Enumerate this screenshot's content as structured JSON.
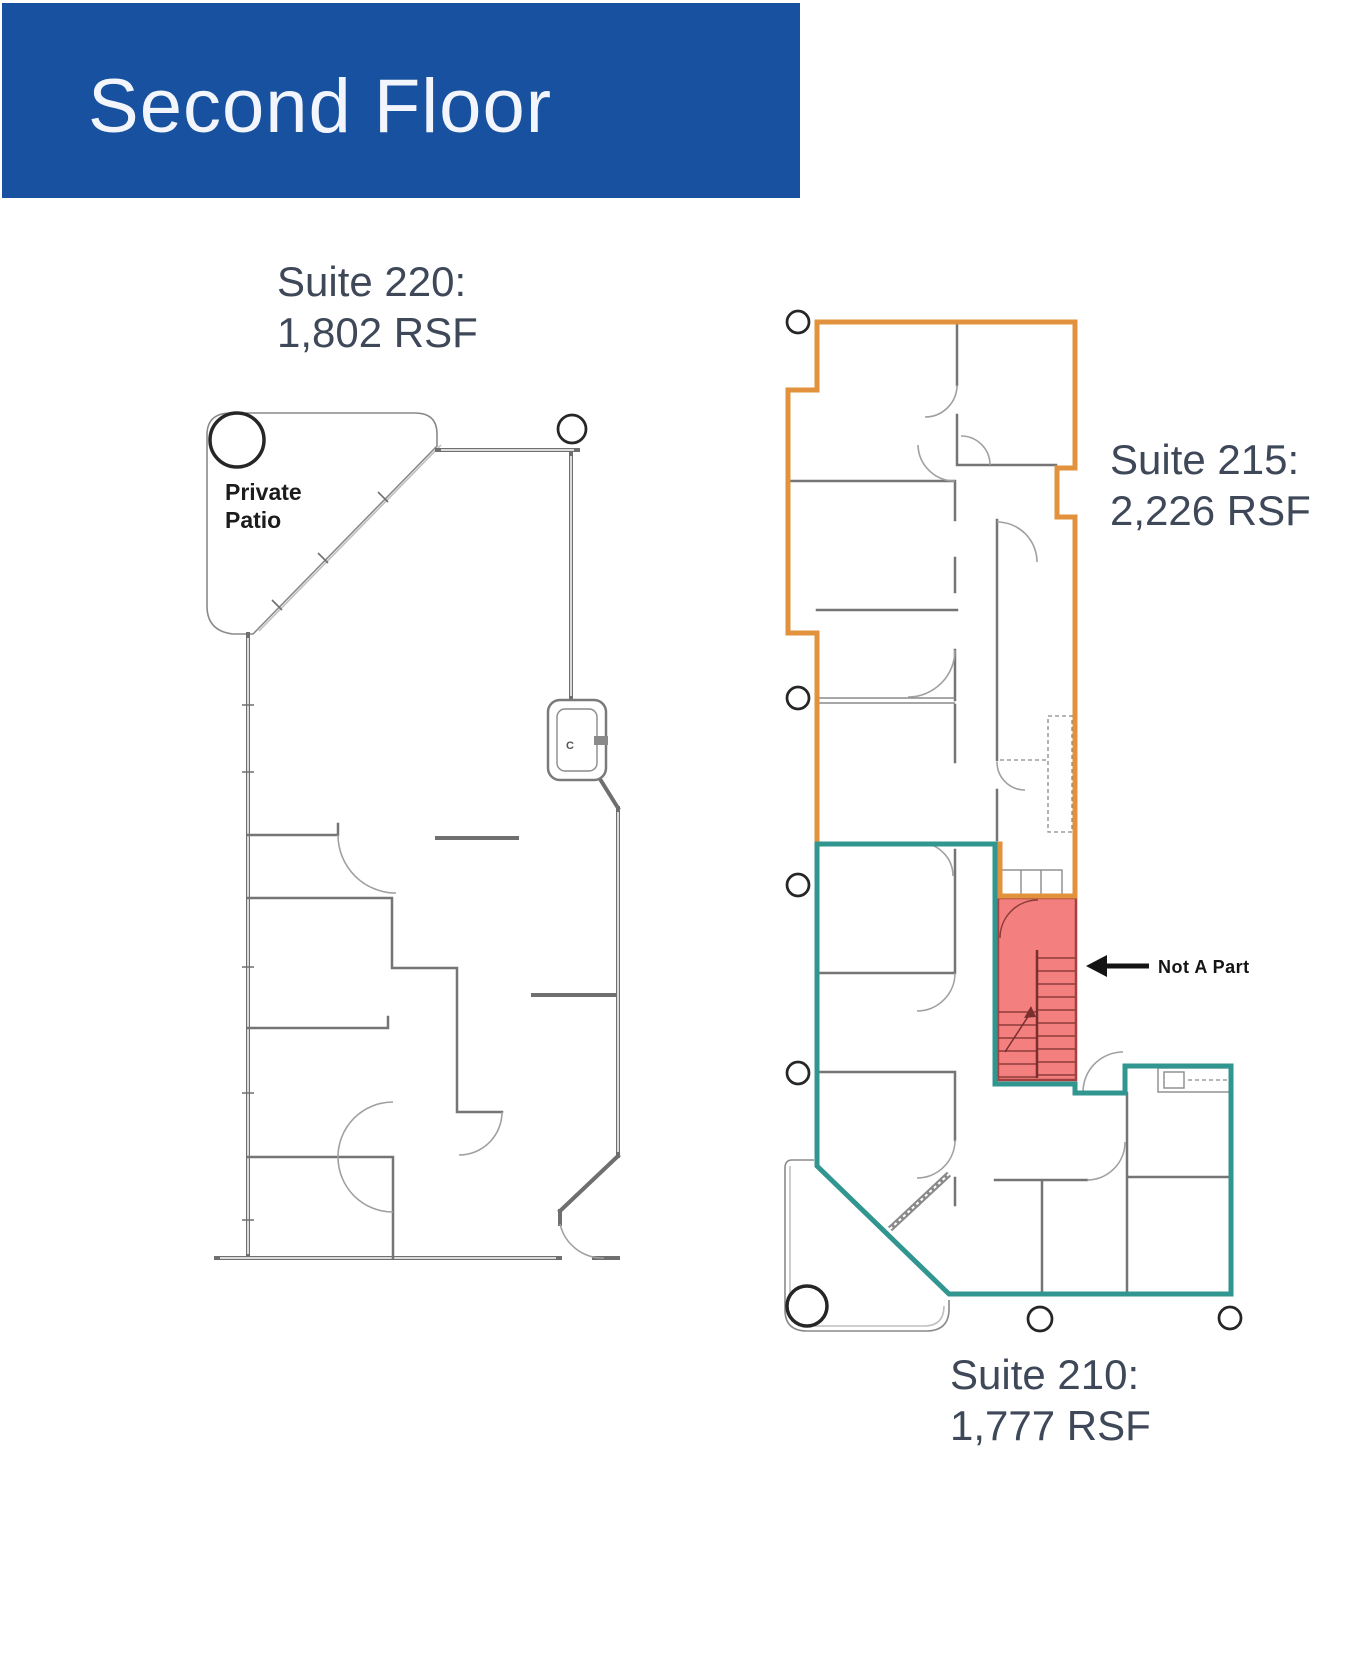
{
  "header": {
    "title": "Second Floor",
    "background_color": "#17519F"
  },
  "plans": {
    "suite_220": {
      "title": "Suite 220:",
      "area": "1,802 RSF",
      "patio_line1": "Private",
      "patio_line2": "Patio",
      "fixture_label": "C"
    },
    "suite_215": {
      "title": "Suite 215:",
      "area": "2,226 RSF",
      "outline_color": "#E2923C"
    },
    "suite_210": {
      "title": "Suite 210:",
      "area": "1,777 RSF",
      "outline_color": "#319690"
    },
    "excluded": {
      "label": "Not A Part",
      "fill_color": "#F3807F",
      "border_color": "#A5403E"
    }
  }
}
